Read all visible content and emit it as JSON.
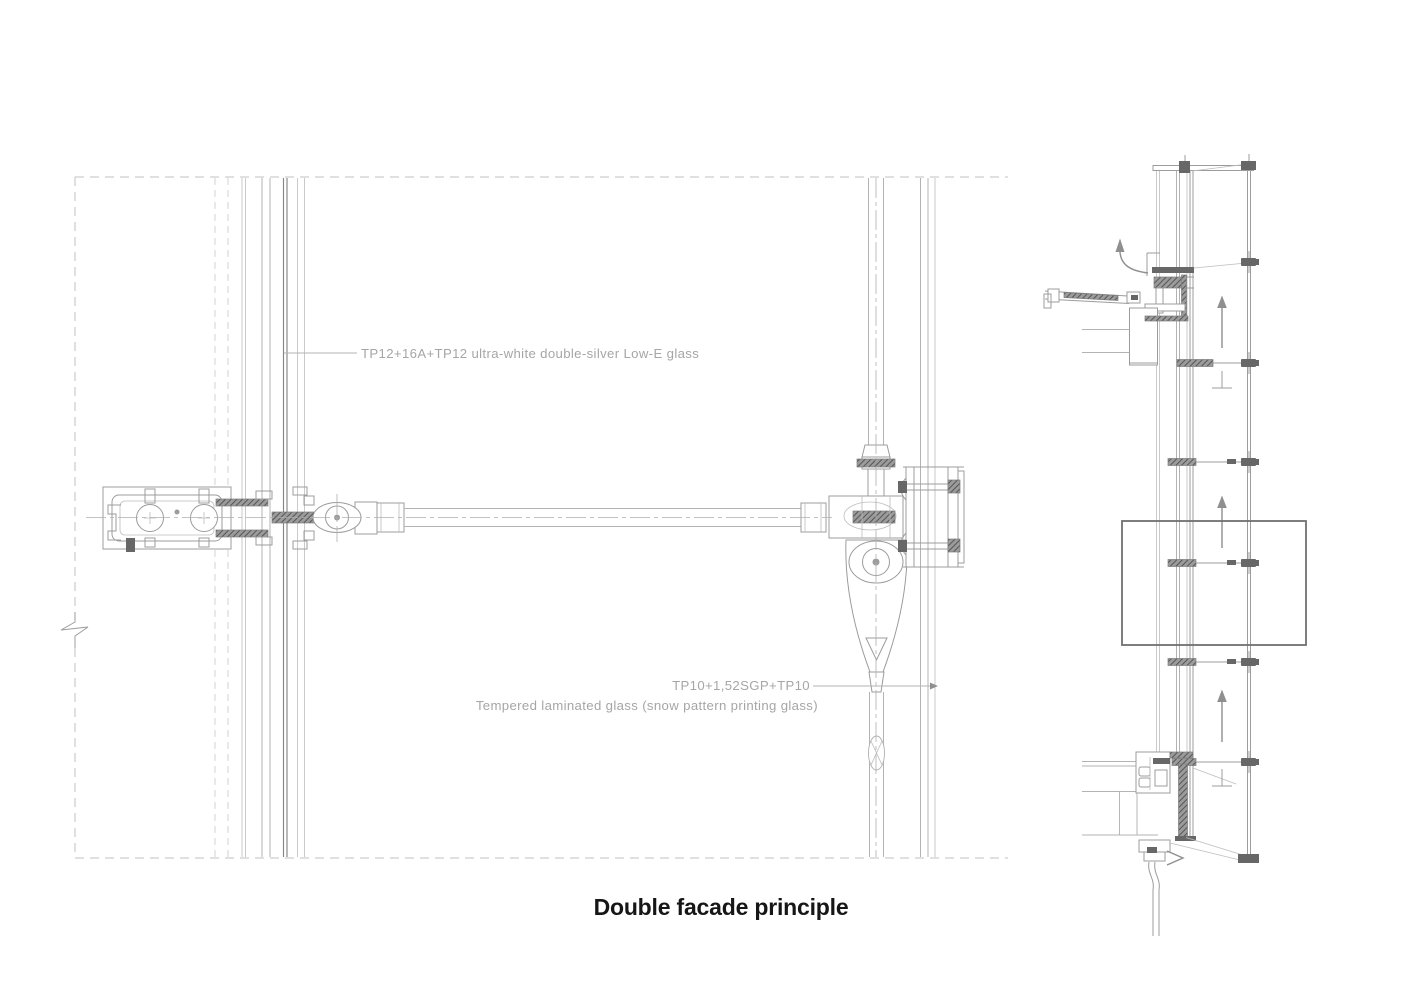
{
  "title": "Double facade principle",
  "plan_view": {
    "inner_glass_label": "TP12+16A+TP12 ultra-white double-silver Low-E glass",
    "outer_glass_spec_label": "TP10+1,52SGP+TP10",
    "outer_glass_desc_label": "Tempered laminated glass (snow pattern printing glass)"
  },
  "colors": {
    "background": "#ffffff",
    "drawing_line_light": "#b3b3b3",
    "drawing_line_medium": "#9c9c9c",
    "drawing_line_dark": "#7d7d7d",
    "hardware_fill": "#676767",
    "label_text": "#a6a6a6",
    "title_text": "#161616",
    "callout_box": "#707070"
  },
  "icons": {
    "airflow_up_arrow": "upward cavity airflow arrow",
    "airflow_exhaust_arrow": "curved exhaust airflow arrow",
    "airflow_intake_chevron": "air intake chevron",
    "break_symbol": "drawing break zigzag",
    "level_mark": "inverted-T level mark"
  }
}
